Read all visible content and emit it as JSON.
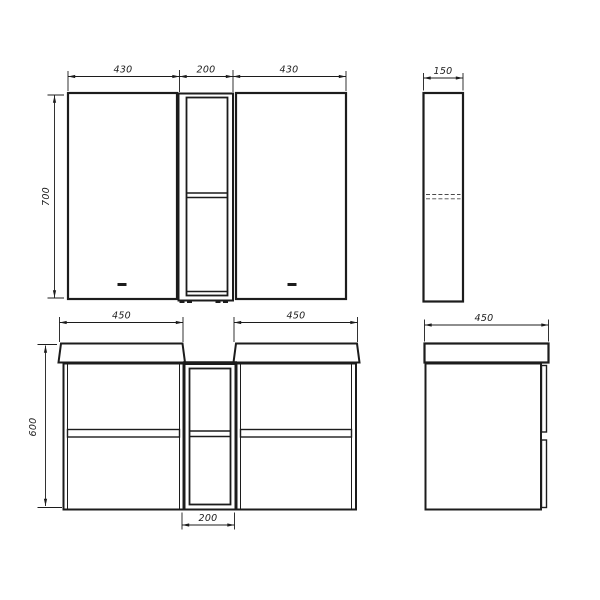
{
  "drawing": {
    "background": "#ffffff",
    "line_color": "#1c1c1c",
    "mirror_front": {
      "dim_left_width": "430",
      "dim_center_width": "200",
      "dim_right_width": "430",
      "dim_height": "700"
    },
    "mirror_side": {
      "dim_depth": "150"
    },
    "vanity_front": {
      "dim_left_width": "450",
      "dim_right_width": "450",
      "dim_height": "600",
      "dim_center_width": "200"
    },
    "vanity_side": {
      "dim_depth": "450"
    }
  }
}
